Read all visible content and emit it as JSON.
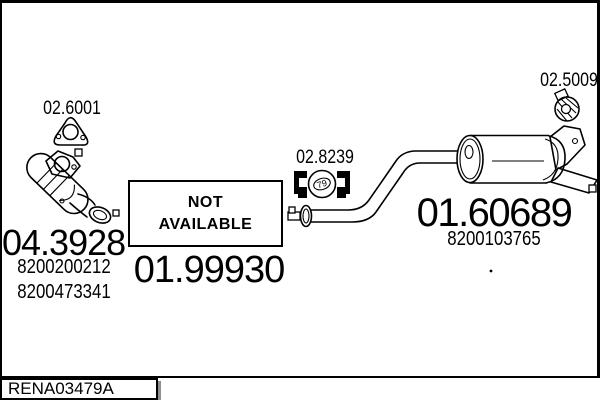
{
  "colors": {
    "ink": "#000000",
    "paper": "#ffffff",
    "box_shadow": "#8f8f8f"
  },
  "parts": {
    "gasket": {
      "code": "02.6001"
    },
    "catalytic": {
      "code": "04.3928",
      "oe_numbers": [
        "8200200212",
        "8200473341"
      ]
    },
    "mid_pipe": {
      "code": "01.99930",
      "availability": [
        "NOT",
        "AVAILABLE"
      ]
    },
    "clamp": {
      "code": "02.8239",
      "size": "79"
    },
    "rear_muffler": {
      "code": "01.60689",
      "oe_numbers": [
        "8200103765"
      ]
    },
    "mount": {
      "code": "02.5009"
    }
  },
  "footer": {
    "drawing_ref": "RENA03479A"
  },
  "icons": {
    "gasket": "triangular-flange-gasket-icon",
    "clamp": "exhaust-clamp-icon",
    "mount": "rubber-mount-icon",
    "markers": "clamp-position-marker"
  }
}
